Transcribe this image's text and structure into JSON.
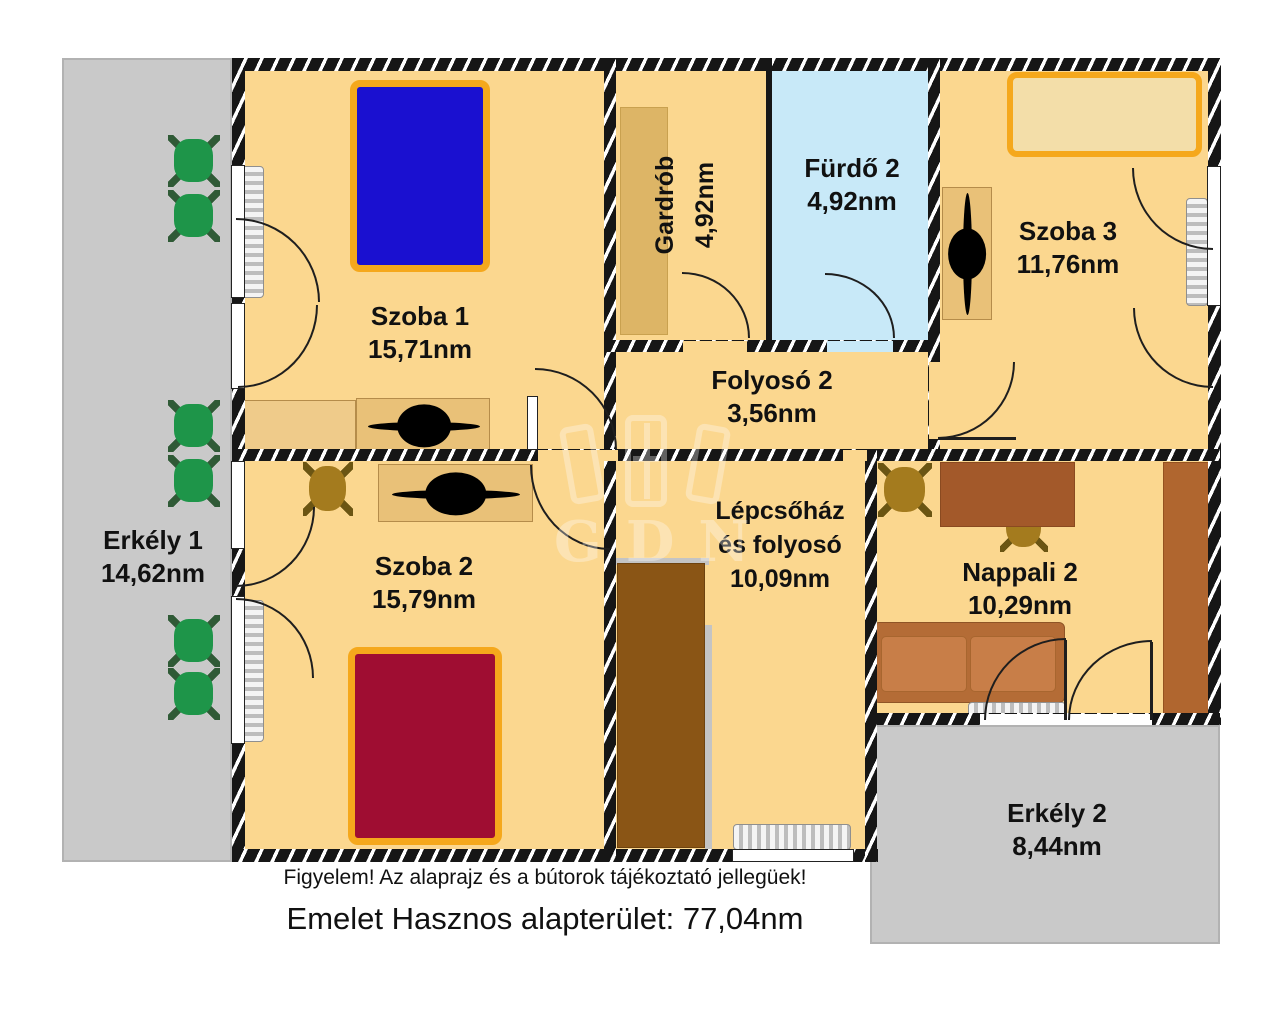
{
  "rooms": {
    "szoba1": {
      "name": "Szoba 1",
      "area": "15,71nm"
    },
    "szoba2": {
      "name": "Szoba 2",
      "area": "15,79nm"
    },
    "szoba3": {
      "name": "Szoba 3",
      "area": "11,76nm"
    },
    "gardrob": {
      "name": "Gardrób",
      "area": "4,92nm"
    },
    "furdo2": {
      "name": "Fürdő 2",
      "area": "4,92nm"
    },
    "folyoso2": {
      "name": "Folyosó 2",
      "area": "3,56nm"
    },
    "lepcsohaz": {
      "name_line1": "Lépcsőház",
      "name_line2": "és folyosó",
      "area": "10,09nm"
    },
    "nappali2": {
      "name": "Nappali 2",
      "area": "10,29nm"
    },
    "erkely1": {
      "name": "Erkély 1",
      "area": "14,62nm"
    },
    "erkely2": {
      "name": "Erkély 2",
      "area": "8,44nm"
    }
  },
  "footer": {
    "disclaimer": "Figyelem! Az alaprajz és a bútorok tájékoztató jellegüek!",
    "total": "Emelet Hasznos alapterület: 77,04nm"
  },
  "watermark": {
    "text": "GDN"
  },
  "colors": {
    "floor": "#FBD78F",
    "bath_floor": "#C8E9F8",
    "balcony": "#C9C9C9",
    "wall": "#161616",
    "bed_blue": "#1A10D0",
    "bed_red": "#9F0D32",
    "bed_tan": "#F3DEA9",
    "bed_frame_orange": "#F5A81C",
    "green_chair": "#1E9549",
    "brown_chair": "#A47B1E",
    "stairs_brown": "#8A5515",
    "sofa_brown": "#B46C36",
    "furniture_tan": "#E9C178"
  }
}
